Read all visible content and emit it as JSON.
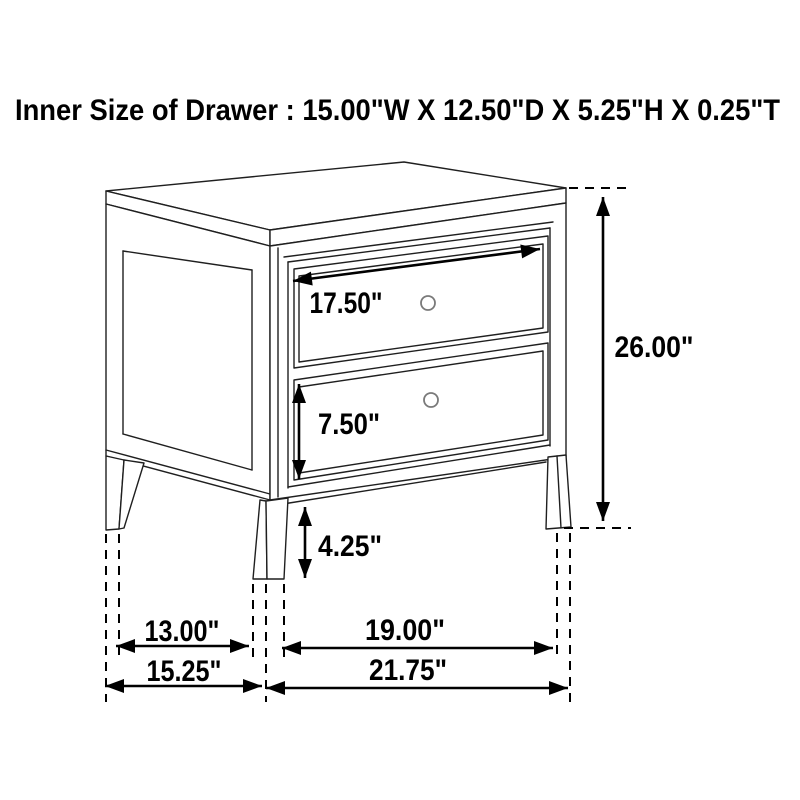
{
  "page": {
    "title": "Inner Size of Drawer : 15.00\"W X 12.50\"D X 5.25\"H X 0.25\"T",
    "background_color": "#ffffff",
    "line_color": "#1f1f1f",
    "dimension_color": "#000000",
    "knob_color": "#7a7a7a"
  },
  "diagram": {
    "type": "furniture-dimension-diagram",
    "dimensions": {
      "top_drawer_width": {
        "label": "17.50\""
      },
      "bottom_drawer_height": {
        "label": "7.50\""
      },
      "leg_clearance_height": {
        "label": "4.25\""
      },
      "overall_height": {
        "label": "26.00\""
      },
      "side_inner_leg_span": {
        "label": "13.00\""
      },
      "side_overall_depth": {
        "label": "15.25\""
      },
      "front_inner_leg_span": {
        "label": "19.00\""
      },
      "front_overall_width": {
        "label": "21.75\""
      }
    }
  }
}
